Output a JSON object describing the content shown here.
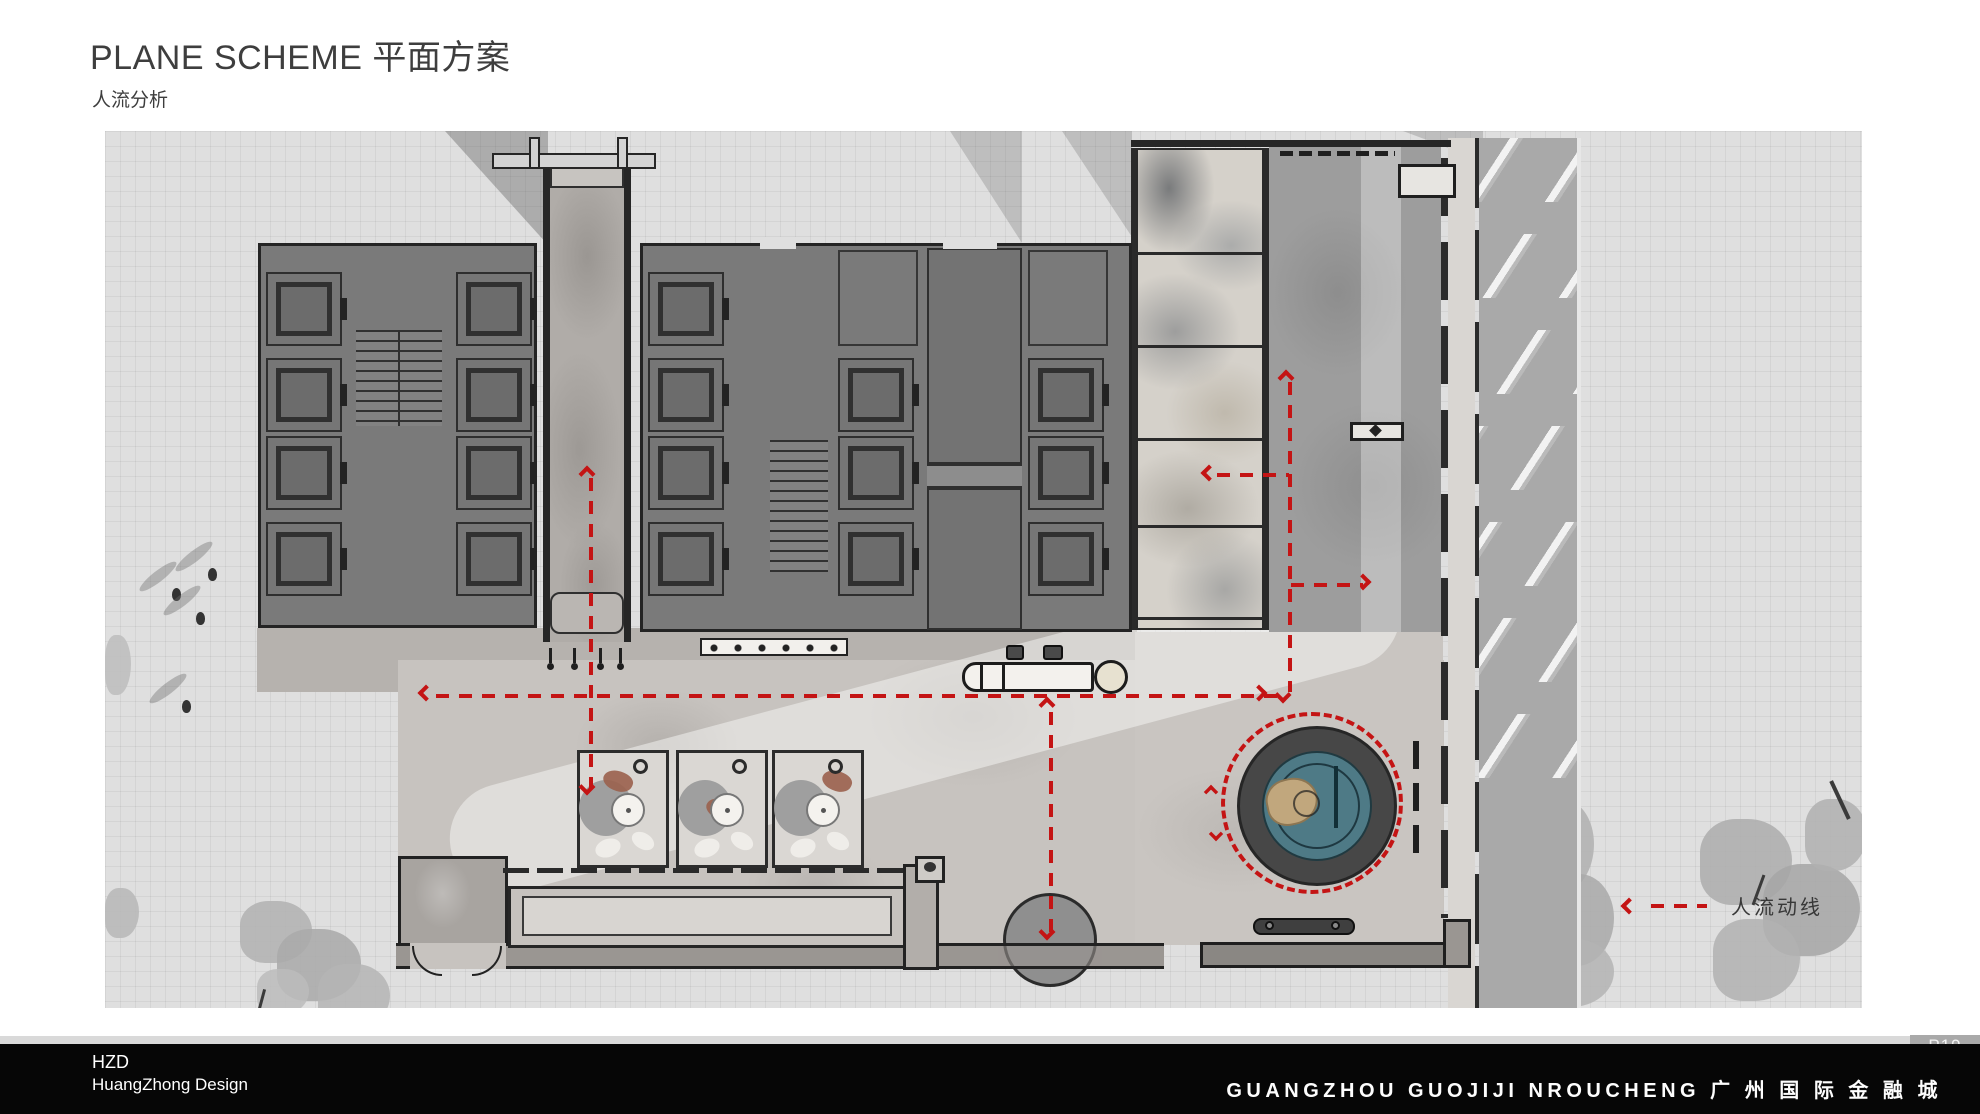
{
  "header": {
    "title": "PLANE SCHEME 平面方案",
    "subtitle": "人流分析"
  },
  "plan": {
    "legend_label": "人流动线"
  },
  "footer": {
    "company_abbr": "HZD",
    "company_name": "HuangZhong Design",
    "project_title": "GUANGZHOU GUOJIJI NROUCHENG 广 州 国 际 金 融 城",
    "page_number": "P19"
  },
  "colors": {
    "flow_accent": "#c41414",
    "pool_water": "#4e7a86",
    "building_fill": "#7a7a7a",
    "footer_bg": "#060606",
    "page_badge_bg": "#a9a9a9",
    "plan_ground": "#dfdfdf"
  }
}
